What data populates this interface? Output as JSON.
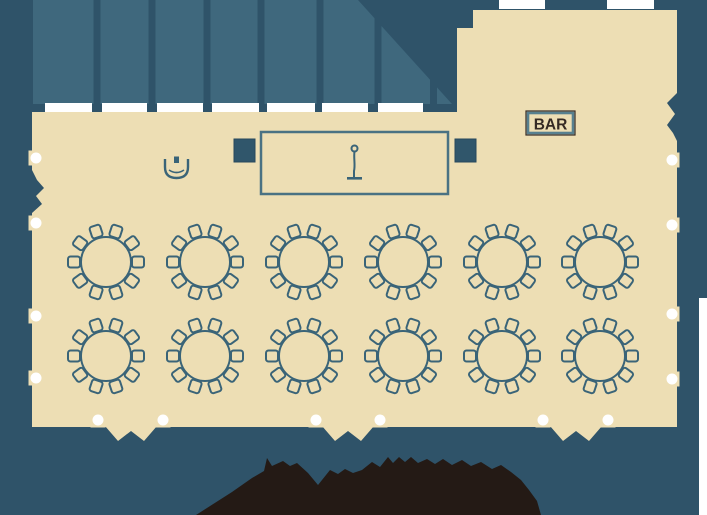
{
  "floor_plan": {
    "description": "banquet-room-seating-floor-plan",
    "bar_sign": {
      "label": "BAR"
    },
    "stage": {
      "x": 261,
      "y": 132,
      "width": 187,
      "height": 62,
      "icon": "microphone-icon"
    },
    "speakers": [
      {
        "x": 234,
        "y": 139,
        "width": 21,
        "height": 23
      },
      {
        "x": 455,
        "y": 139,
        "width": 21,
        "height": 23
      }
    ],
    "piano": {
      "x": 164,
      "y": 156,
      "icon": "piano-icon"
    },
    "tables": {
      "count": 12,
      "rows": 2,
      "columns": 6,
      "seats_per_table": 10,
      "radius": 25,
      "chair_offset": 31,
      "centers": [
        [
          106,
          262
        ],
        [
          205,
          262
        ],
        [
          304,
          262
        ],
        [
          403,
          262
        ],
        [
          502,
          262
        ],
        [
          600,
          262
        ],
        [
          106,
          356
        ],
        [
          205,
          356
        ],
        [
          304,
          356
        ],
        [
          403,
          356
        ],
        [
          502,
          356
        ],
        [
          600,
          356
        ]
      ]
    },
    "terrace": {
      "separators": [
        93.5,
        148.5,
        203.5,
        257.5,
        316.5,
        374.5,
        430
      ],
      "windows": [
        [
          45,
          47
        ],
        [
          102,
          45
        ],
        [
          157,
          46
        ],
        [
          212,
          47
        ],
        [
          267,
          48
        ],
        [
          322,
          46
        ],
        [
          378,
          45
        ]
      ]
    },
    "extension_windows": [
      [
        499,
        46
      ],
      [
        607,
        47
      ]
    ],
    "door_markers": {
      "left_wall_y": [
        158,
        223,
        316,
        378
      ],
      "right_wall_y": [
        160,
        225,
        314,
        379
      ],
      "bottom_wall_x": [
        98,
        163,
        316,
        380,
        543,
        608
      ]
    },
    "door_swings_bottom_x": [
      131,
      348,
      576
    ],
    "colors": {
      "background": "#2f5369",
      "terrace": "#3f687d",
      "floor": "#eddeb4",
      "line": "#3a6478",
      "stage_line": "#4a7283",
      "bar_border": "#57808f",
      "bar_text": "#352a24",
      "speaker_fill": "#30566b",
      "marker_white": "#ffffff",
      "logo_dark": "#241a15"
    }
  }
}
